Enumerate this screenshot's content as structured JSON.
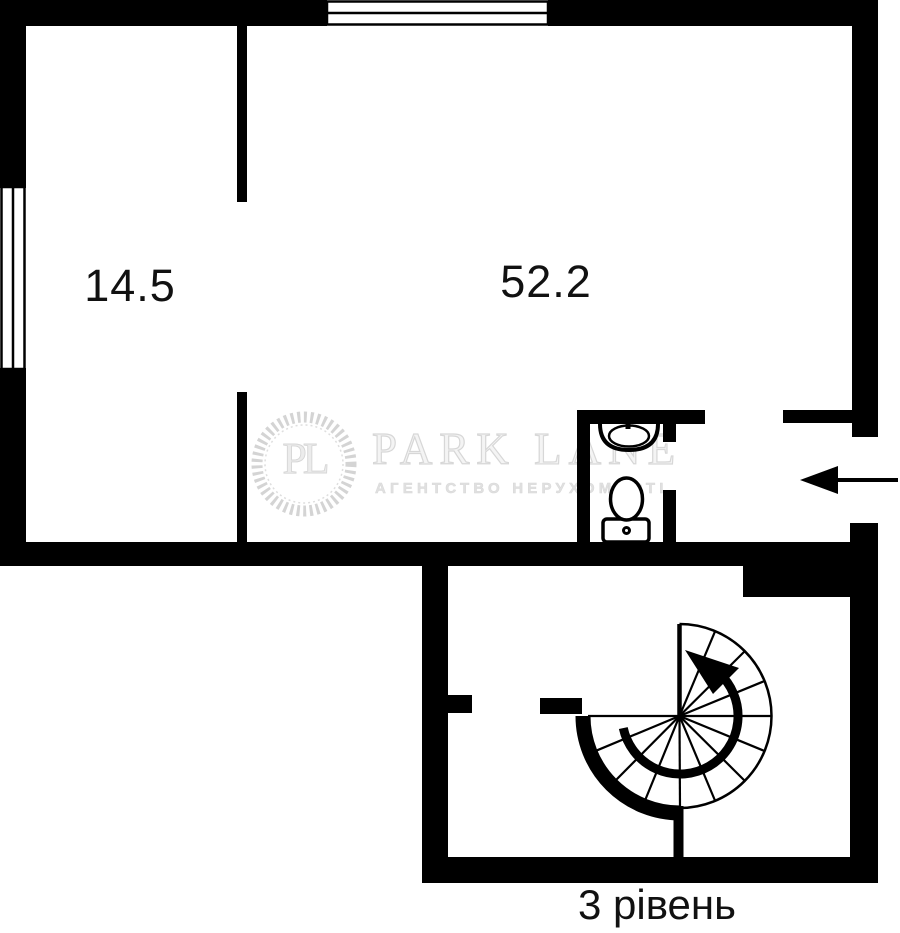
{
  "plan": {
    "level_label": "3 рівень",
    "rooms": [
      {
        "id": "room-small",
        "area_label": "14.5"
      },
      {
        "id": "room-large",
        "area_label": "52.2"
      }
    ],
    "icons": [
      "window",
      "sink-icon",
      "toilet-icon",
      "spiral-staircase-icon",
      "entrance-arrow-icon"
    ],
    "colors": {
      "walls": "#000000",
      "background": "#ffffff",
      "label_text": "#111111",
      "watermark": "#dcdcdc"
    }
  },
  "watermark": {
    "initials": "PL",
    "brand": "PARK LANE",
    "tagline": "АГЕНТСТВО НЕРУХОМОСТІ"
  }
}
